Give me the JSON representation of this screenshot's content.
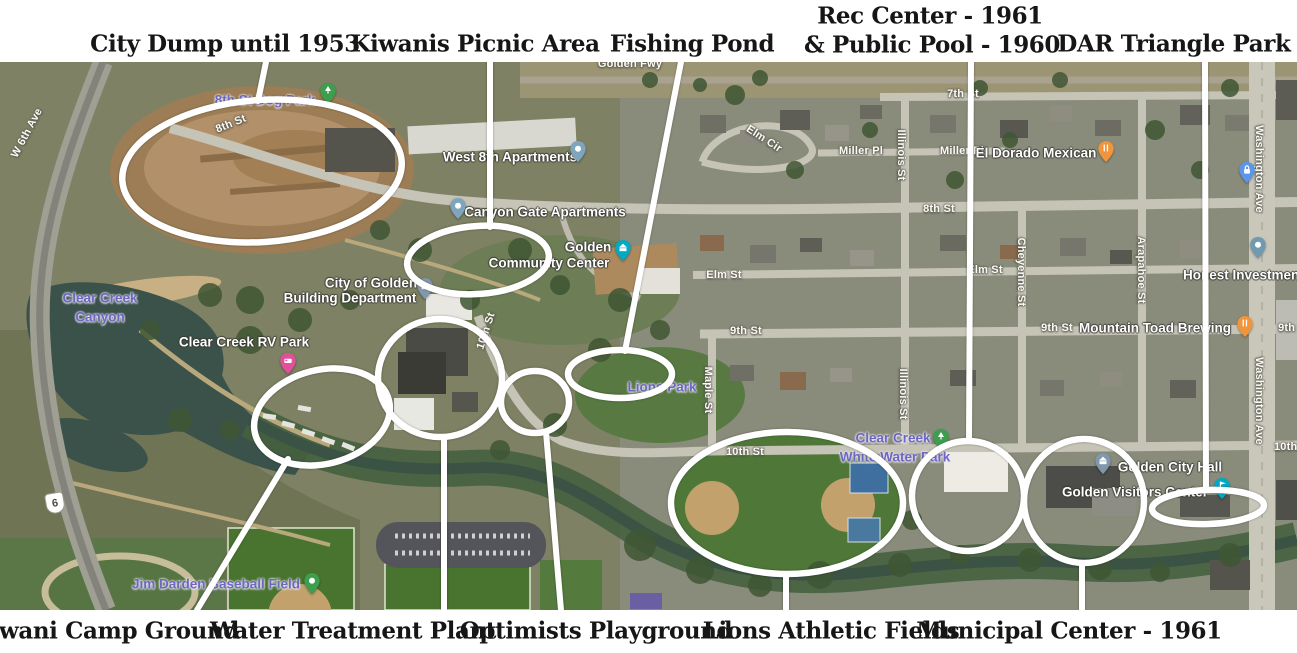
{
  "annotations": {
    "top": [
      {
        "id": "city-dump",
        "text": "City Dump until 1953"
      },
      {
        "id": "kiwanis-picnic",
        "text": "Kiwanis Picnic Area"
      },
      {
        "id": "fishing-pond",
        "text": "Fishing Pond"
      },
      {
        "id": "rec-center",
        "line1": "Rec Center - 1961",
        "line2": "& Public Pool - 1960"
      },
      {
        "id": "dar-triangle",
        "text": "DAR Triangle Park"
      }
    ],
    "bottom": [
      {
        "id": "kiwani-camp",
        "text": "Kiwani Camp Ground"
      },
      {
        "id": "water-treatment",
        "text": "Water Treatment Plant"
      },
      {
        "id": "optimists",
        "text": "Optimists Playground"
      },
      {
        "id": "lions-fields",
        "text": "Lions Athletic Fields"
      },
      {
        "id": "municipal-center",
        "text": "Municipal Center - 1961"
      }
    ]
  },
  "map_labels": {
    "streets": [
      {
        "text": "W 6th Ave"
      },
      {
        "text": "Golden Fwy"
      },
      {
        "text": "8th St"
      },
      {
        "text": "8th St"
      },
      {
        "text": "7th St"
      },
      {
        "text": "Elm Cir"
      },
      {
        "text": "Miller Pl"
      },
      {
        "text": "Miller Pl"
      },
      {
        "text": "Illinois St"
      },
      {
        "text": "Illinois St"
      },
      {
        "text": "Elm St"
      },
      {
        "text": "Elm St"
      },
      {
        "text": "9th St"
      },
      {
        "text": "9th St"
      },
      {
        "text": "9th St"
      },
      {
        "text": "10th St"
      },
      {
        "text": "10th St"
      },
      {
        "text": "Maple St"
      },
      {
        "text": "Cheyenne St"
      },
      {
        "text": "Arapahoe St"
      },
      {
        "text": "Washington Ave"
      },
      {
        "text": "Washington Ave"
      },
      {
        "text": "10th St"
      }
    ],
    "places": [
      {
        "text": "West 8th Apartments"
      },
      {
        "text": "Canyon Gate Apartments"
      },
      {
        "lines": [
          "Golden",
          "Community Center"
        ]
      },
      {
        "lines": [
          "City of Golden",
          "Building Department"
        ]
      },
      {
        "text": "Clear Creek RV Park"
      },
      {
        "text": "El Dorado Mexican"
      },
      {
        "text": "Honest Investment"
      },
      {
        "text": "Mountain Toad Brewing"
      },
      {
        "text": "Golden City Hall"
      },
      {
        "text": "Golden Visitors Center"
      }
    ],
    "parks": [
      {
        "lines": [
          "Clear Creek",
          "Canyon"
        ]
      },
      {
        "text": "8th St Dog Park"
      },
      {
        "text": "Lions Park"
      },
      {
        "lines": [
          "Clear Creek",
          "White Water Park"
        ]
      },
      {
        "text": "Jim Darden Baseball Field"
      }
    ],
    "route_shield": {
      "text": "6"
    }
  },
  "pins": [
    {
      "name": "west-8th-apartments-pin",
      "icon": "map-pin",
      "color": "#7fa5bd"
    },
    {
      "name": "canyon-gate-apartments-pin",
      "icon": "map-pin",
      "color": "#7fa5bd"
    },
    {
      "name": "community-center-pin",
      "icon": "civic-building-pin",
      "color": "#00a9c4"
    },
    {
      "name": "building-department-pin",
      "icon": "bank-pin",
      "color": "#7f98ab"
    },
    {
      "name": "rv-park-pin",
      "icon": "rv-pin",
      "color": "#e44f9c"
    },
    {
      "name": "dog-park-pin",
      "icon": "tree-pin",
      "color": "#3d9e4e"
    },
    {
      "name": "el-dorado-mexican-pin",
      "icon": "restaurant-pin",
      "color": "#f0953c"
    },
    {
      "name": "lock-pin",
      "icon": "lock-pin",
      "color": "#5b96e8"
    },
    {
      "name": "honest-investment-pin",
      "icon": "map-pin",
      "color": "#6f9ab0"
    },
    {
      "name": "mountain-toad-brewing-pin",
      "icon": "restaurant-pin",
      "color": "#f0953c"
    },
    {
      "name": "white-water-park-pin",
      "icon": "tree-pin",
      "color": "#3d9e4e"
    },
    {
      "name": "golden-city-hall-pin",
      "icon": "bank-pin",
      "color": "#7f98ab"
    },
    {
      "name": "visitors-center-pin",
      "icon": "flag-pin",
      "color": "#00a9c4"
    },
    {
      "name": "jim-darden-field-pin",
      "icon": "dot-pin",
      "color": "#3d9e4e"
    }
  ],
  "colors": {
    "annotation_ink": "#161616",
    "highlight_stroke": "#ffffff",
    "park_label": "#6f66c2",
    "poi_label": "#ffffff",
    "street_label": "#fbfbf3",
    "water": "#3a524a",
    "dirt": "#b2906a",
    "urban_base": "#8a8c7b",
    "field_green": "#4f7838"
  }
}
